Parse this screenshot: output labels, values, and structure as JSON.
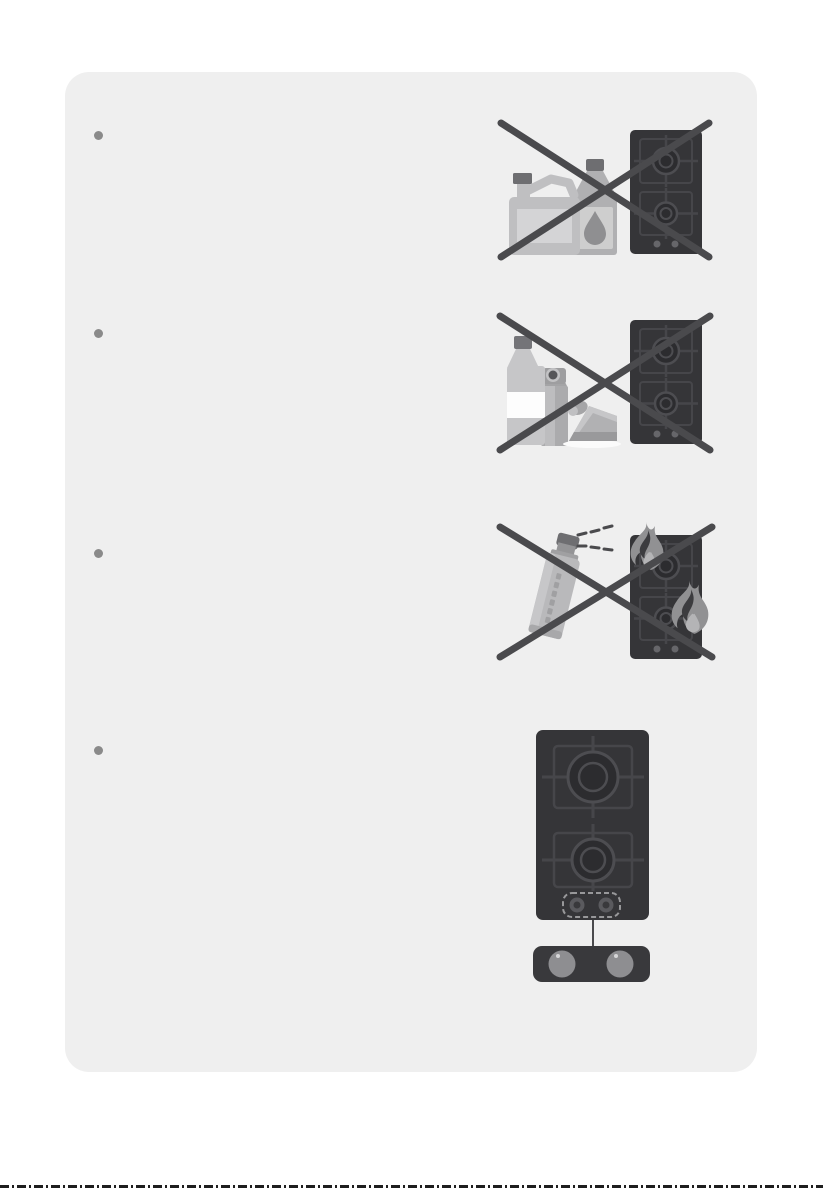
{
  "colors": {
    "page_bg": "#ffffff",
    "card_bg": "#efefef",
    "bullet": "#8a8a8a",
    "cross": "#4a4a4d",
    "hob_body": "#353538",
    "hob_line": "#46464a",
    "hob_ring": "#4d4d51",
    "hob_burner": "#2c2c2f",
    "hob_dot": "#66666a",
    "item_gray": "#bfbfc1",
    "item_mid": "#b0b0b2",
    "item_light": "#d4d4d6",
    "item_dark": "#6e6e71",
    "flame_outer": "#919193",
    "flame_dark": "#3c3c3f",
    "flame_inner": "#b4b4b6",
    "panel_body": "#39393c",
    "knob": "#8e8e91",
    "cut_line": "#1e1e1e"
  },
  "warnings": [
    {
      "marker": "•",
      "figure_icon": "flammable-liquid-containers-and-hob-crossed-icon"
    },
    {
      "marker": "•",
      "figure_icon": "bottle-spray-cake-and-hob-crossed-icon"
    },
    {
      "marker": "•",
      "figure_icon": "aerosol-spray-and-burning-hob-crossed-icon"
    },
    {
      "marker": "•",
      "figure_icon": "hob-top-view-with-control-knob-panel-icon"
    }
  ]
}
